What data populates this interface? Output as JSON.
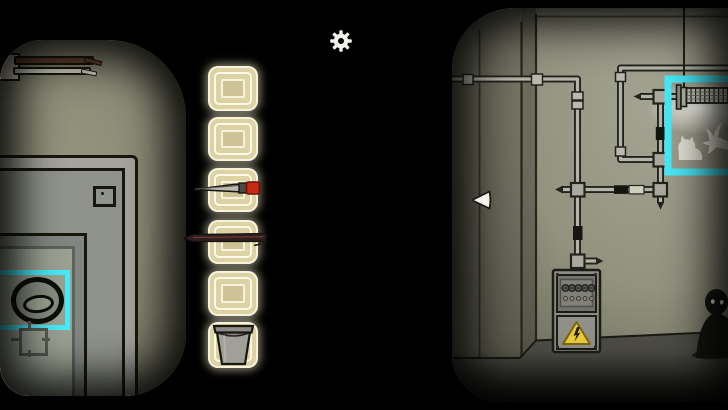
{
  "app": {
    "title": "Rusty-Lake style escape room scene",
    "settings_label": "Settings",
    "highlight_color": "#46e9f8"
  },
  "navigation": {
    "left_arrow_label": "Look left"
  },
  "inventory": {
    "slots": [
      {
        "index": 1,
        "item": "",
        "title": "Empty inventory slot"
      },
      {
        "index": 2,
        "item": "",
        "title": "Empty inventory slot"
      },
      {
        "index": 3,
        "item": "scalpel",
        "title": "Scalpel"
      },
      {
        "index": 4,
        "item": "metal rod",
        "title": "Metal rod"
      },
      {
        "index": 5,
        "item": "",
        "title": "Empty inventory slot"
      },
      {
        "index": 6,
        "item": "bucket",
        "title": "Bucket"
      }
    ]
  },
  "left_room": {
    "title": "Safe door view",
    "objects": {
      "wires": "Cut wires in wall",
      "safe": "Safe door",
      "dial": "Safe dial",
      "dial_highlight": "Highlighted dial zone",
      "knob": "Crosshair knob"
    }
  },
  "right_room": {
    "title": "Basement wall view",
    "objects": {
      "pipes": "Pipe network",
      "lamp": "Fluorescent lamp",
      "lamp_highlight": "Highlighted lamp zone",
      "cat": "Cat silhouette",
      "bird": "Bird silhouette",
      "fusebox": "Fuse box with warning sign",
      "figure": "Shadow figure"
    }
  },
  "colors": {
    "highlight": "#46e9f8",
    "warning_yellow": "#e9cb3a",
    "scalpel_red": "#c62a12",
    "slot_beige": "#dcd2a4"
  }
}
